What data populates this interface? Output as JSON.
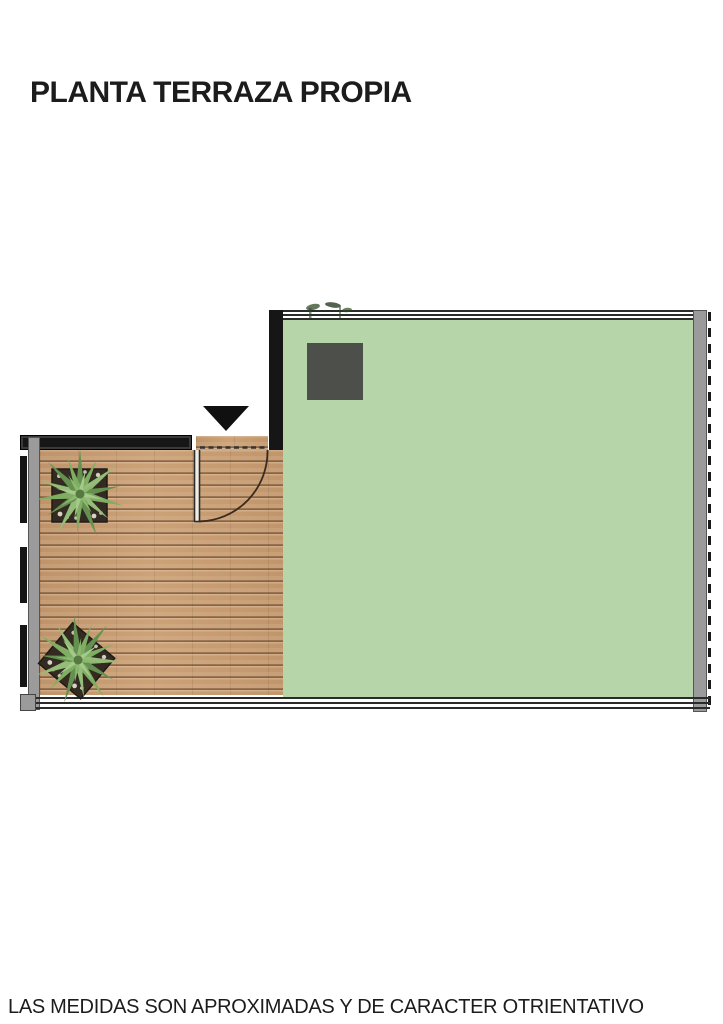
{
  "title": "PLANTA TERRAZA PROPIA",
  "disclaimer": "LAS MEDIDAS SON APROXIMADAS Y DE CARACTER OTRIENTATIVO",
  "floorplan": {
    "type": "terrace-top-view-plan",
    "green_terrace": {
      "color": "#b6d6a9"
    },
    "wood_deck": {
      "color": "#c99c70",
      "plank_line_color": "#6b4c33"
    },
    "dark_rooftop_box": {
      "color": "#4d4f4a"
    },
    "entrance_arrow": {
      "shape": "triangle-down",
      "color": "#101010"
    },
    "walls": {
      "black": "#161616",
      "gray": "#9b9b9b",
      "railing_line": "#2a2a2a",
      "outer_dash": "#1b1b1b"
    },
    "door": {
      "swing": "quarter-arc",
      "line_color": "#3b2a1d",
      "opening": "dashed"
    },
    "plants": {
      "count": 2,
      "type": "agave-top-view",
      "leaf_colors": [
        "#7fae63",
        "#659150",
        "#94bd77"
      ],
      "planter_color": "#332b22"
    }
  }
}
